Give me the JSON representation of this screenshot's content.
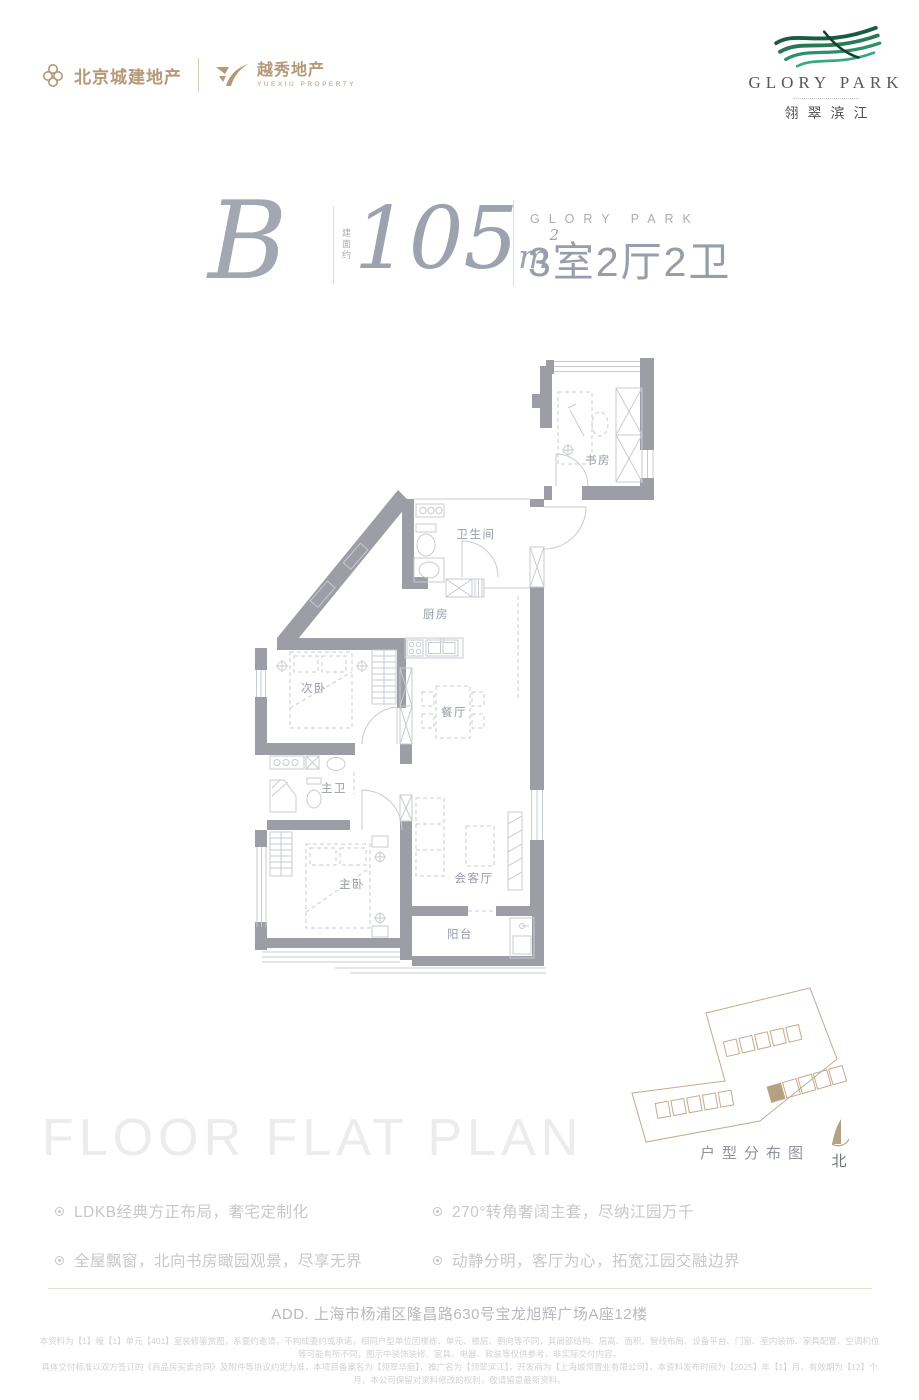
{
  "header": {
    "brand_left": {
      "name1": "北京城建地产",
      "name2": "越秀地产",
      "name2_sub": "YUEXIU PROPERTY"
    },
    "brand_right": {
      "name_en": "GLORY PARK",
      "name_cn": "翎翠滨江"
    }
  },
  "title": {
    "unit": "B",
    "area_note": "建面约",
    "area_value": "105",
    "area_unit_base": "m",
    "area_unit_sup": "2",
    "brand_en": "GLORY PARK",
    "layout": "3室2厅2卫"
  },
  "floor_plan": {
    "rooms": {
      "study": "书房",
      "bathroom": "卫生间",
      "kitchen": "厨房",
      "second_bedroom": "次卧",
      "dining": "餐厅",
      "master_bath": "主卫",
      "master_bedroom": "主卧",
      "living": "会客厅",
      "balcony": "阳台"
    }
  },
  "site_plan": {
    "caption": "户型分布图",
    "north_label": "北"
  },
  "watermark": "FLOOR FLAT PLAN",
  "features": [
    "LDKB经典方正布局，奢宅定制化",
    "全屋飘窗，北向书房瞰园观景，尽享无界",
    "270°转角奢阔主套，尽纳江园万千",
    "动静分明，客厅为心，拓宽江园交融边界"
  ],
  "footer": {
    "address": "ADD. 上海市杨浦区隆昌路630号宝龙旭辉广场A座12楼",
    "disclaimer_line1": "本资料为【1】幢【1】单元【401】室装修鉴赏图，系要约邀请，不构成要约或承诺，相同户型单位因楼栋、单元、楼层、朝向等不同，其局部结构、层高、面积、管线布局、设备平台、门窗、室内装饰、家具配置、空调机位等可能有所不同，图示中装饰装修、家具、电器、软装等仅供参考，非实际交付内容，",
    "disclaimer_line2": "具体交付标准以双方签订的《商品房买卖合同》及附件等协议约定为准，本项目备案名为【翎翠华庭】，推广名为【翎翠滨江】，开发商为【上海城翎置业有限公司】，本资料发布时间为【2025】年【1】月，有效期为【12】个月，本公司保留对资料修改的权利，敬请留意最新资料。"
  }
}
